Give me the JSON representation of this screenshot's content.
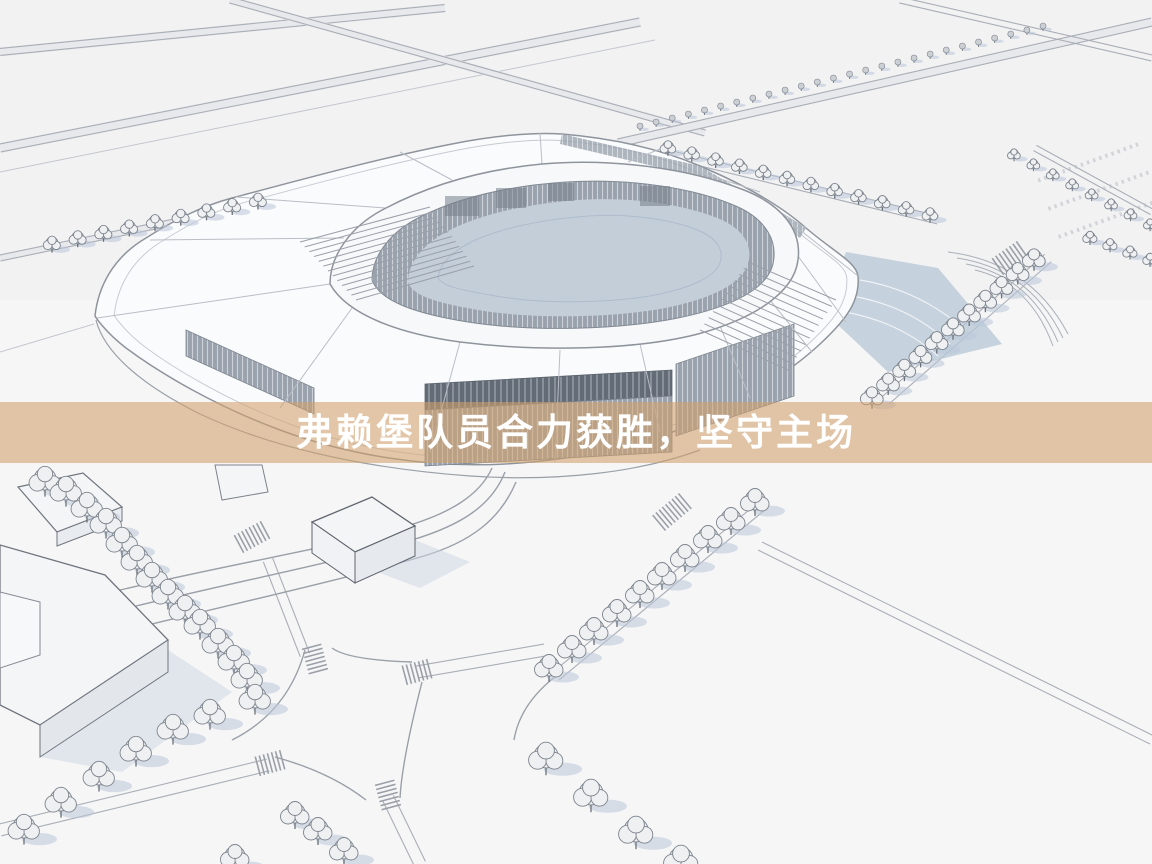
{
  "banner": {
    "headline": "弗赖堡队员合力获胜，坚守主场",
    "bg": "rgba(210,160,106,0.58)",
    "text_color": "#ffffff"
  },
  "palette": {
    "paper": "#f6f6f7",
    "road_band": "#e8e9ec",
    "line_soft": "#c3c7cd",
    "line_strong": "#8e949c",
    "roof_white": "#fafbfc",
    "louver_gray": "#9aa3ad",
    "louver_stripe": "#ccd2d8",
    "glass_dark": "#626b76",
    "bowl_floor": "#c3ced9",
    "terrace_blue": "#b6c5d4",
    "tree_fill": "#eef0f2",
    "tree_stroke": "#7d848d",
    "shadow_blue": "#b9c7d8",
    "building_white": "#f4f5f7"
  },
  "scene": {
    "subject": "stadium-aerial-3d-model",
    "tree_rows": [
      {
        "name": "row-top-tiny",
        "from": [
          640,
          126
        ],
        "to": [
          1043,
          26
        ],
        "count": 26,
        "radius": 3
      },
      {
        "name": "row-northeast",
        "from": [
          668,
          147
        ],
        "to": [
          930,
          214
        ],
        "count": 12,
        "radius": 5.5
      },
      {
        "name": "row-east",
        "from": [
          1034,
          258
        ],
        "to": [
          872,
          396
        ],
        "count": 11,
        "radius": 8
      },
      {
        "name": "row-parking-a",
        "from": [
          1014,
          154
        ],
        "to": [
          1150,
          224
        ],
        "count": 8,
        "radius": 4.5
      },
      {
        "name": "row-parking-b",
        "from": [
          1090,
          237
        ],
        "to": [
          1150,
          259
        ],
        "count": 4,
        "radius": 5
      },
      {
        "name": "row-northwest",
        "from": [
          52,
          243
        ],
        "to": [
          258,
          200
        ],
        "count": 9,
        "radius": 6
      },
      {
        "name": "row-southwest-arc",
        "points": [
          [
            45,
            479
          ],
          [
            66,
            489
          ],
          [
            87,
            505
          ],
          [
            106,
            521
          ],
          [
            122,
            540
          ],
          [
            137,
            558
          ],
          [
            152,
            575
          ],
          [
            168,
            592
          ],
          [
            185,
            608
          ],
          [
            200,
            622
          ],
          [
            218,
            641
          ],
          [
            234,
            658
          ],
          [
            247,
            676
          ],
          [
            255,
            697
          ]
        ],
        "radius": 11
      },
      {
        "name": "row-southwest-lower",
        "points": [
          [
            210,
            712
          ],
          [
            173,
            727
          ],
          [
            136,
            749
          ],
          [
            99,
            774
          ],
          [
            61,
            800
          ],
          [
            24,
            827
          ]
        ],
        "radius": 11
      },
      {
        "name": "row-center-diagonal",
        "points": [
          [
            755,
            500
          ],
          [
            731,
            519
          ],
          [
            708,
            537
          ],
          [
            685,
            556
          ],
          [
            662,
            574
          ],
          [
            640,
            592
          ],
          [
            617,
            611
          ],
          [
            594,
            629
          ],
          [
            572,
            647
          ],
          [
            549,
            666
          ]
        ],
        "radius": 10
      },
      {
        "name": "row-south",
        "points": [
          [
            546,
            756
          ],
          [
            591,
            793
          ],
          [
            636,
            830
          ],
          [
            681,
            859
          ]
        ],
        "radius": 12
      },
      {
        "name": "row-bottom-scatter",
        "points": [
          [
            235,
            856
          ],
          [
            295,
            813
          ],
          [
            318,
            829
          ],
          [
            344,
            849
          ]
        ],
        "radius": 10
      }
    ],
    "crosswalks": [
      {
        "x": 672,
        "y": 512,
        "angle": 50,
        "count": 9
      },
      {
        "x": 252,
        "y": 537,
        "angle": 62,
        "count": 8
      },
      {
        "x": 1010,
        "y": 258,
        "angle": 55,
        "count": 8
      },
      {
        "x": 315,
        "y": 659,
        "angle": -15,
        "count": 7
      },
      {
        "x": 417,
        "y": 672,
        "angle": 75,
        "count": 7
      },
      {
        "x": 388,
        "y": 795,
        "angle": -15,
        "count": 7
      },
      {
        "x": 270,
        "y": 763,
        "angle": 75,
        "count": 7
      }
    ]
  }
}
